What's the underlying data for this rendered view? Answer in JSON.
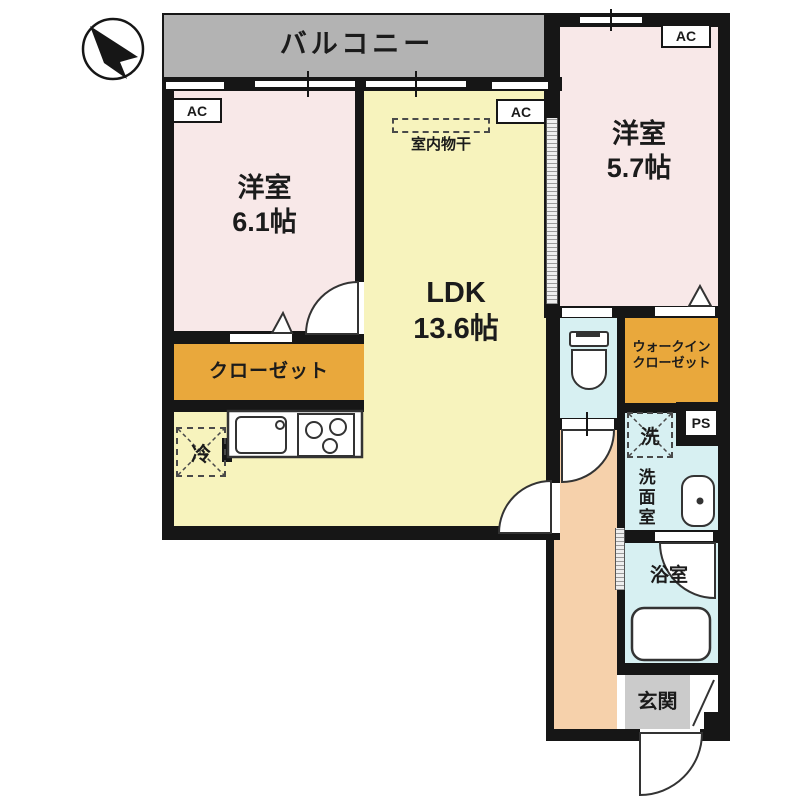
{
  "balcony": {
    "label": "バルコニー"
  },
  "rooms": {
    "bedroom1": {
      "name": "洋室",
      "size": "6.1帖"
    },
    "bedroom2": {
      "name": "洋室",
      "size": "5.7帖"
    },
    "ldk": {
      "name": "LDK",
      "size": "13.6帖"
    },
    "closet": {
      "label": "クローゼット"
    },
    "walk_in_closet": {
      "line1": "ウォークイン",
      "line2": "クローゼット"
    },
    "washroom": {
      "label": "洗面室"
    },
    "bathroom": {
      "label": "浴室"
    },
    "entrance": {
      "label": "玄関"
    }
  },
  "labels": {
    "ac": "AC",
    "ps": "PS",
    "washer": "洗",
    "fridge": "冷",
    "indoor_laundry": "室内物干"
  },
  "colors": {
    "wall": "#161616",
    "bedroom": "#f8e8e8",
    "ldk": "#f7f3bd",
    "closet": "#e9a83c",
    "water": "#d7f0f2",
    "corridor": "#f6d1ab",
    "balcony": "#b3b3b3",
    "entrance_floor": "#cbcbcb"
  }
}
